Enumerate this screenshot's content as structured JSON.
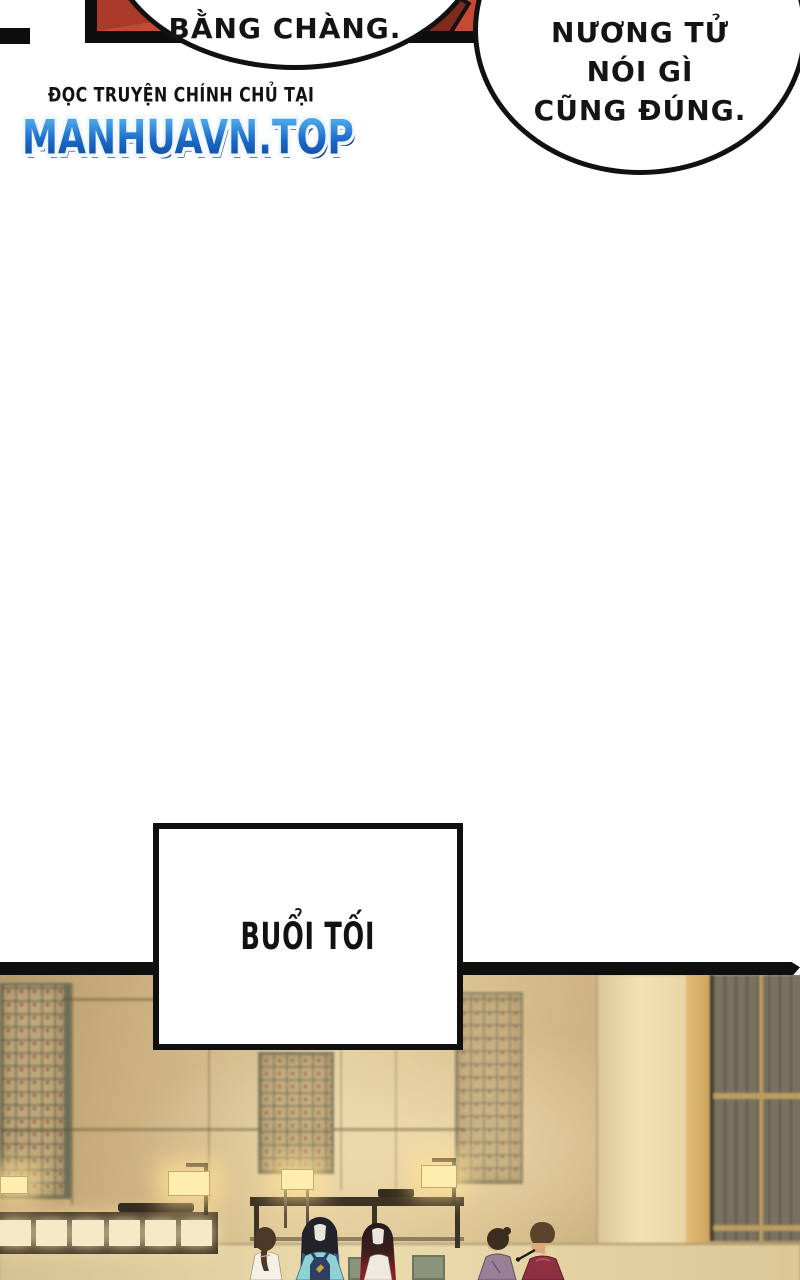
{
  "bubbles": {
    "left": {
      "text": "BẰNG CHÀNG."
    },
    "right": {
      "lines": [
        "NƯƠNG TỬ",
        "NÓI GÌ",
        "CŨNG ĐÚNG."
      ]
    }
  },
  "watermark": {
    "tagline": "ĐỌC TRUYỆN CHÍNH CHỦ TẠI",
    "site": "MANHUAVN.TOP",
    "site_color": "#1b6ac9"
  },
  "caption": {
    "text": "BUỔI TỐI"
  },
  "scene": {
    "description": "evening inn interior with lattice windows, glowing lamps, counters and five figures",
    "figures": [
      "woman-white-robe-ponytail",
      "man-long-hair-teal-robe",
      "woman-red-tipped-hair-white-top",
      "person-purple-robe",
      "man-dark-red-robe-with-pipe"
    ],
    "colors": {
      "panel_red": "#c64a33",
      "wall": "#c9ae7e",
      "wall_light": "#f1e1b4",
      "lamp": "#ffedb0",
      "counter": "#473828",
      "counter_panel": "#f5e9c8",
      "door": "#7a7260",
      "rail": "#bd9d62",
      "floor": "#e2cd9c"
    }
  }
}
